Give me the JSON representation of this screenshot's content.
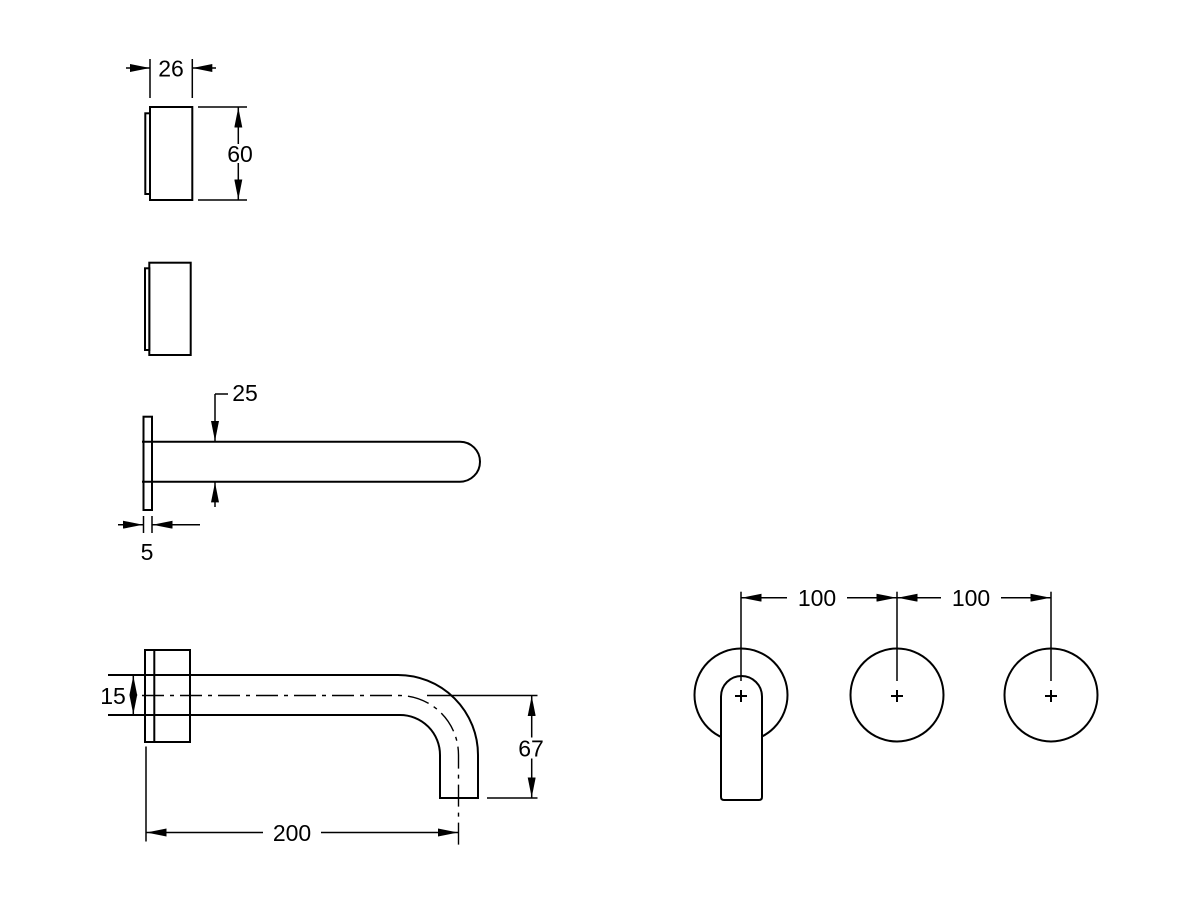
{
  "colors": {
    "line": "#000000",
    "background": "#ffffff"
  },
  "dims": {
    "handle_width": "26",
    "handle_height": "60",
    "spout_diameter": "25",
    "flange_thickness": "5",
    "spout_outlet_height": "15",
    "spout_drop": "67",
    "spout_reach": "200",
    "pitch_left": "100",
    "pitch_right": "100"
  }
}
